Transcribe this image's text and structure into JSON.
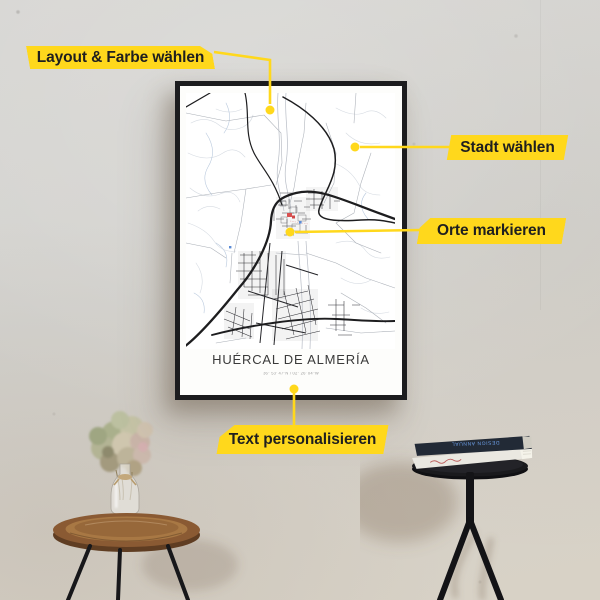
{
  "ui": {
    "callouts": [
      {
        "id": "layout",
        "label": "Layout & Farbe wählen"
      },
      {
        "id": "stadt",
        "label": "Stadt wählen"
      },
      {
        "id": "orte",
        "label": "Orte markieren"
      },
      {
        "id": "text",
        "label": "Text personalisieren"
      }
    ]
  },
  "poster": {
    "title": "HUÉRCAL DE ALMERÍA",
    "coordinates": "36° 53' 47''N / 02° 26' 04''W",
    "markers": {
      "poi_marker_color": "#d95050",
      "selection_dot_color": "#ffd81c"
    }
  },
  "props": {
    "book_top_title": "DESIGN ANNUAL"
  },
  "colors": {
    "accent_yellow": "#ffd81c",
    "label_text": "#1f1f1f",
    "frame_black": "#1c1c1e",
    "wall_gray": "#d4d3cf",
    "marker_red": "#d95050"
  }
}
